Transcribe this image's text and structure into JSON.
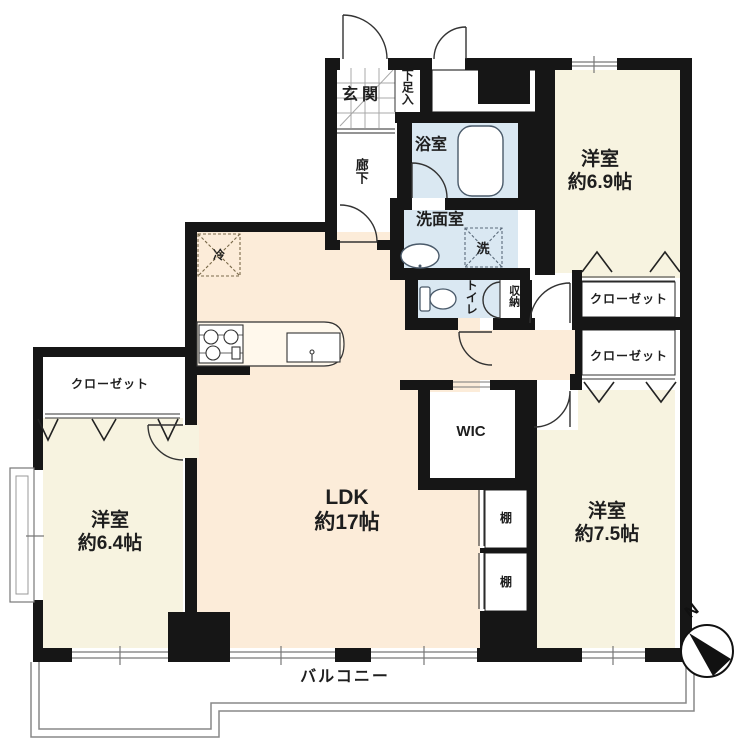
{
  "title": "間取り図",
  "colors": {
    "wall": "#161616",
    "bedroom_floor": "#f7f3e0",
    "ldk_floor": "#fcecd9",
    "wet_area_floor": "#dae8f2",
    "fence": "#888888",
    "line": "#333333"
  },
  "rooms": {
    "entrance": {
      "label": "玄関"
    },
    "shoe_cabinet": {
      "label": "下足入"
    },
    "hallway": {
      "label": "廊下"
    },
    "bathroom": {
      "label": "浴室"
    },
    "washroom": {
      "label": "洗面室"
    },
    "washer_space": {
      "label": "洗"
    },
    "toilet": {
      "label": "トイレ"
    },
    "storage": {
      "label": "収納"
    },
    "bedroom_ne": {
      "label": "洋室",
      "size": "約6.9帖"
    },
    "closet_ne": {
      "label": "クローゼット"
    },
    "closet_e": {
      "label": "クローゼット"
    },
    "bedroom_se": {
      "label": "洋室",
      "size": "約7.5帖"
    },
    "walk_in_closet": {
      "label": "WIC"
    },
    "shelf_upper": {
      "label": "棚"
    },
    "shelf_lower": {
      "label": "棚"
    },
    "living": {
      "label": "LDK",
      "size": "約17帖"
    },
    "closet_w": {
      "label": "クローゼット"
    },
    "bedroom_w": {
      "label": "洋室",
      "size": "約6.4帖"
    },
    "balcony": {
      "label": "バルコニー"
    },
    "refrigerator": {
      "label": "冷"
    }
  },
  "compass": {
    "label": "N"
  }
}
